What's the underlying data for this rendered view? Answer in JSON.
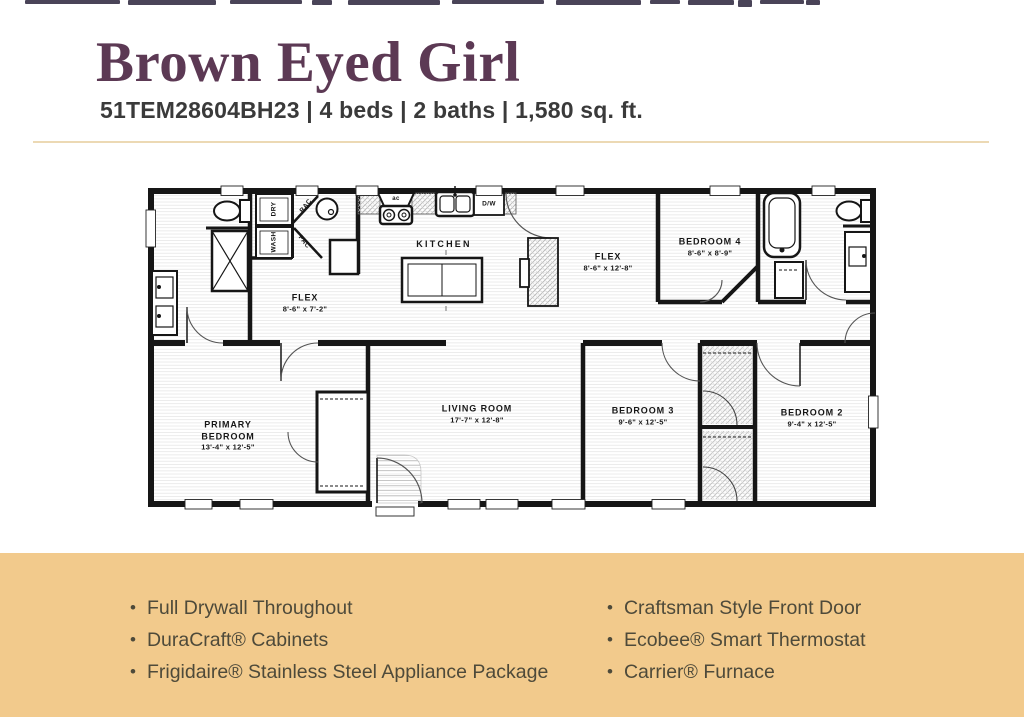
{
  "header": {
    "title": "Brown Eyed Girl",
    "subtitle": "51TEM28604BH23 | 4 beds | 2 baths | 1,580 sq. ft.",
    "title_color": "#5c3954"
  },
  "colors": {
    "band": "#f2ca8c",
    "divider": "#ecd9b4",
    "feature_text": "#4e4a3a",
    "walls": "#161616"
  },
  "floorplan": {
    "rooms": [
      {
        "name": "KITCHEN",
        "dims": ""
      },
      {
        "name": "FLEX",
        "dims": "8'-6\" x 7'-2\""
      },
      {
        "name": "FLEX",
        "dims": "8'-6\" x 12'-8\""
      },
      {
        "name": "BEDROOM 4",
        "dims": "8'-6\" x 8'-9\""
      },
      {
        "name": "PRIMARY BEDROOM",
        "dims": "13'-4\" x 12'-5\""
      },
      {
        "name": "LIVING ROOM",
        "dims": "17'-7\" x 12'-8\""
      },
      {
        "name": "BEDROOM 3",
        "dims": "9'-6\" x 12'-5\""
      },
      {
        "name": "BEDROOM 2",
        "dims": "9'-4\" x 12'-5\""
      }
    ],
    "fixtures": {
      "dryer": "DRY",
      "washer": "WASH",
      "rac": "RAC",
      "pac": "PAC",
      "dishwasher": "D/W",
      "range_vent": "ac"
    }
  },
  "features": {
    "left": [
      "Full Drywall Throughout",
      "DuraCraft® Cabinets",
      "Frigidaire® Stainless Steel Appliance Package"
    ],
    "right": [
      "Craftsman Style Front Door",
      "Ecobee® Smart Thermostat",
      "Carrier® Furnace"
    ]
  }
}
